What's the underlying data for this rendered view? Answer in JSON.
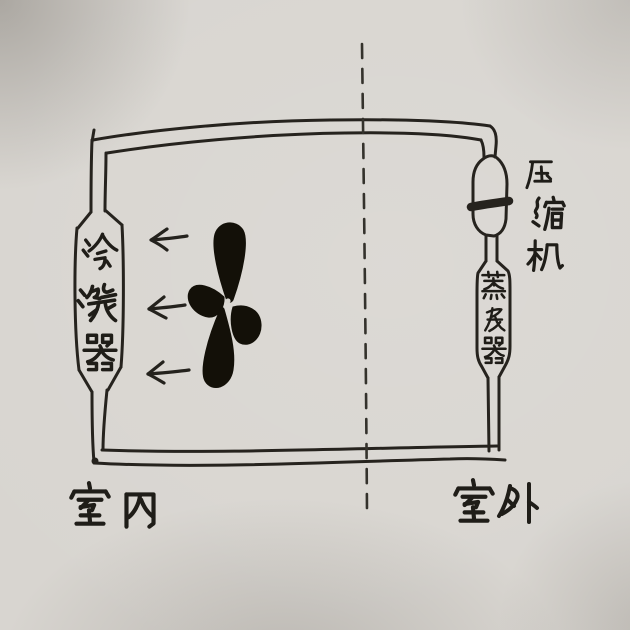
{
  "colors": {
    "paper": "#d8d5d0",
    "ink": "#23211c"
  },
  "divider": {
    "orientation": "vertical",
    "style": "dashed"
  },
  "zones": {
    "indoor": {
      "label": "室内",
      "side": "left"
    },
    "outdoor": {
      "label": "室外",
      "side": "right"
    }
  },
  "components": {
    "condenser": {
      "label": "冷凝器",
      "zone": "indoor",
      "shape": "capsule"
    },
    "compressor": {
      "label": "压缩机",
      "zone": "outdoor",
      "shape": "capsule-with-band"
    },
    "evaporator": {
      "label": "蒸发器",
      "zone": "outdoor",
      "shape": "capsule"
    },
    "fan": {
      "icon": "fan-propeller-icon",
      "blades": 4,
      "zone": "indoor"
    }
  },
  "airflow": {
    "direction": "left",
    "arrow_count": 3
  },
  "circuit": {
    "shape": "rectangular pipe loop"
  }
}
